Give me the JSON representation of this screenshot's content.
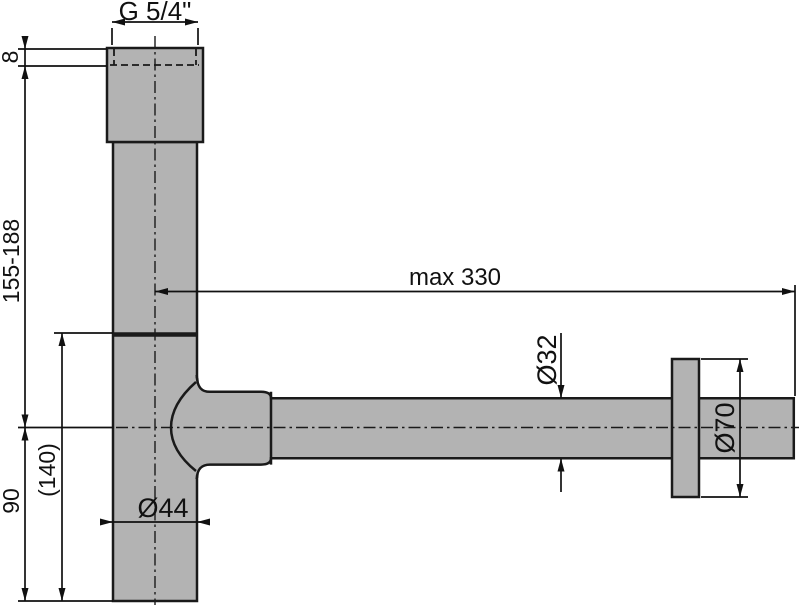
{
  "drawing": {
    "type": "technical-dimension-drawing",
    "subject": "design bottle siphon / washbasin trap, side view",
    "labels": {
      "thread_size": "G 5/4\"",
      "thread_depth": "8",
      "height_range": "155-188",
      "max_reach": "max 330",
      "outlet_pipe_diameter": "Ø32",
      "flange_diameter": "Ø70",
      "body_diameter": "Ø44",
      "body_depth_ref": "(140)",
      "cup_height": "90"
    },
    "colors": {
      "part_fill": "#b3b3b3",
      "outline": "#1a1a1a",
      "dimension_line": "#111111",
      "background": "#ffffff"
    }
  }
}
